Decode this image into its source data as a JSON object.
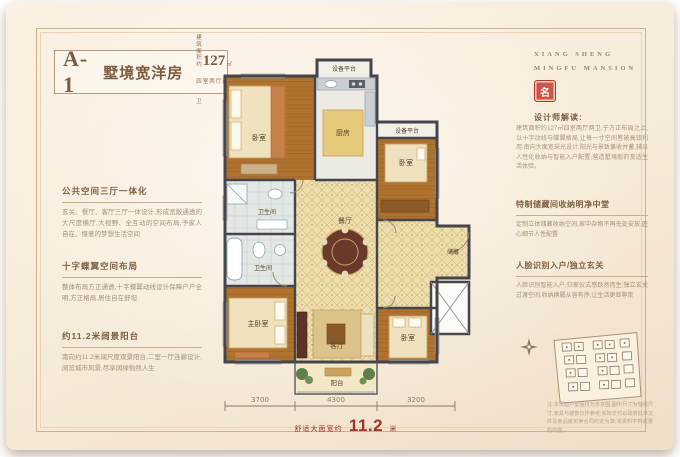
{
  "title": {
    "code": "A-1",
    "name": "墅境宽洋房",
    "area_prefix": "建筑面积约",
    "area_value": "127",
    "area_unit": "㎡",
    "subtitle": "四室两厅两卫"
  },
  "left_blocks": [
    {
      "heading": "公共空间三厅一体化",
      "body": "玄关、餐厅、客厅三厅一体设计,形成宽敞通透的大尺度横厅,大视野、全互动的空间布局,予家人自在、惬意的梦想生活空间"
    },
    {
      "heading": "十字蝶翼空间布局",
      "body": "整体布局方正通透,十字蝶翼动线设计保障户户全明,方正格局,居住自在舒坦"
    },
    {
      "heading": "约11.2米阔景阳台",
      "body": "南向约11.2米阔尺度观景阳台,二室一厅连廊设计,阅览城市风景,尽享阔绰怡然人生"
    }
  ],
  "right": {
    "brand_line1": "XIANG SHENG",
    "brand_line2": "MINGFU MANSION",
    "seal_glyph": "名",
    "interpret_heading": "设计师解读:",
    "interpret_body": "建筑面积约127㎡四室两厅两卫,于方正布局之上,以十字动线与蝶翼格局,让每一寸空间皆被高效利用;南向大面宽采光设计,阳光与景致兼收并蓄,辅以人性化收纳与智能入户配置,营造墅境般的宽适生活体验。",
    "blocks": [
      {
        "heading": "特制储藏间收纳明净中堂",
        "body": "定制立体储藏收纳空间,家中杂物不再无处安放,匠心细节人性配置"
      },
      {
        "heading": "人脸识别入户/独立玄关",
        "body": "人脸识别智能入户,归家仪式感跃然而生;独立玄关过渡空间,收纳换履从容有序,让生活更显尊崇"
      }
    ],
    "disclaimer": "注:本页面户型图仅为示意图,图中尺寸为轴线尺寸,家具与装饰仅作参考;实际交付以政府批准文件及商品房买卖合同约定为准;本资料不构成要约内容。"
  },
  "plan": {
    "rooms": {
      "eq_top": "设备平台",
      "bed_tl": "卧室",
      "kitchen": "厨房",
      "eq_right": "设备平台",
      "bed_r": "卧室",
      "bath_1": "卫生间",
      "bath_2": "卫生间",
      "dining": "餐厅",
      "living": "客厅",
      "master": "主卧室",
      "bed_br": "卧室",
      "balcony": "阳台",
      "storage": "储藏"
    },
    "dimensions": [
      "3700",
      "4300",
      "3200"
    ],
    "width_caption": {
      "prefix": "舒适大面宽约",
      "value": "11.2",
      "unit": "米"
    }
  },
  "colors": {
    "accent_red": "#a1312a",
    "wall": "#45454c",
    "frame": "#cdb090"
  }
}
